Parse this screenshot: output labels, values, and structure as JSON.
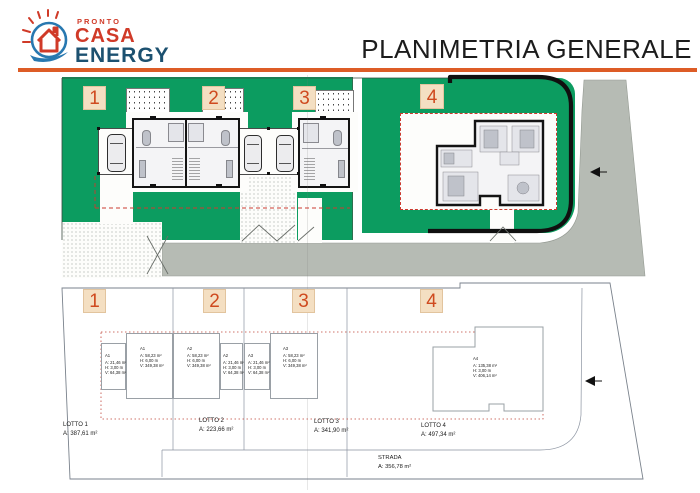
{
  "header": {
    "logo": {
      "line1": "PRONTO",
      "line2": "CASA",
      "line3": "ENERGY"
    },
    "title": "PLANIMETRIA GENERALE"
  },
  "theme": {
    "green": "#0c9c60",
    "road_gray": "#b6bbb4",
    "accent_orange": "#dd5c26",
    "badge_bg": "#f4dfc2",
    "badge_text": "#cf4a1f",
    "logo_red": "#d03a28",
    "logo_blue": "#1c5170",
    "dashed_red": "#cc3b30"
  },
  "site_plan": {
    "lot_badges": [
      "1",
      "2",
      "3",
      "4"
    ]
  },
  "scheme": {
    "lot_badges": [
      "1",
      "2",
      "3",
      "4"
    ],
    "units": [
      {
        "id": "A1",
        "area": "A: 21,46 m²",
        "height": "H: 3,00 m",
        "volume": "V: 64,38 m²"
      },
      {
        "id": "A1",
        "area": "A: 58,23 m²",
        "height": "H: 6,00 m",
        "volume": "V: 349,38 m²"
      },
      {
        "id": "A2",
        "area": "A: 58,23 m²",
        "height": "H: 6,00 m",
        "volume": "V: 349,38 m²"
      },
      {
        "id": "A2",
        "area": "A: 21,46 m²",
        "height": "H: 3,00 m",
        "volume": "V: 64,38 m²"
      },
      {
        "id": "A3",
        "area": "A: 21,46 m²",
        "height": "H: 3,00 m",
        "volume": "V: 64,38 m²"
      },
      {
        "id": "A3",
        "area": "A: 58,23 m²",
        "height": "H: 6,00 m",
        "volume": "V: 349,38 m²"
      },
      {
        "id": "A4",
        "area": "A: 135,38 m²",
        "height": "H: 3,00 m",
        "volume": "V: 406,14 m²"
      }
    ],
    "lots": [
      {
        "name": "LOTTO 1",
        "area": "A: 387,61 m²"
      },
      {
        "name": "LOTTO 2",
        "area": "A: 223,66 m²"
      },
      {
        "name": "LOTTO 3",
        "area": "A: 341,90 m²"
      },
      {
        "name": "LOTTO 4",
        "area": "A: 497,34 m²"
      }
    ],
    "road": {
      "name": "STRADA",
      "area": "A: 356,78 m²"
    }
  }
}
